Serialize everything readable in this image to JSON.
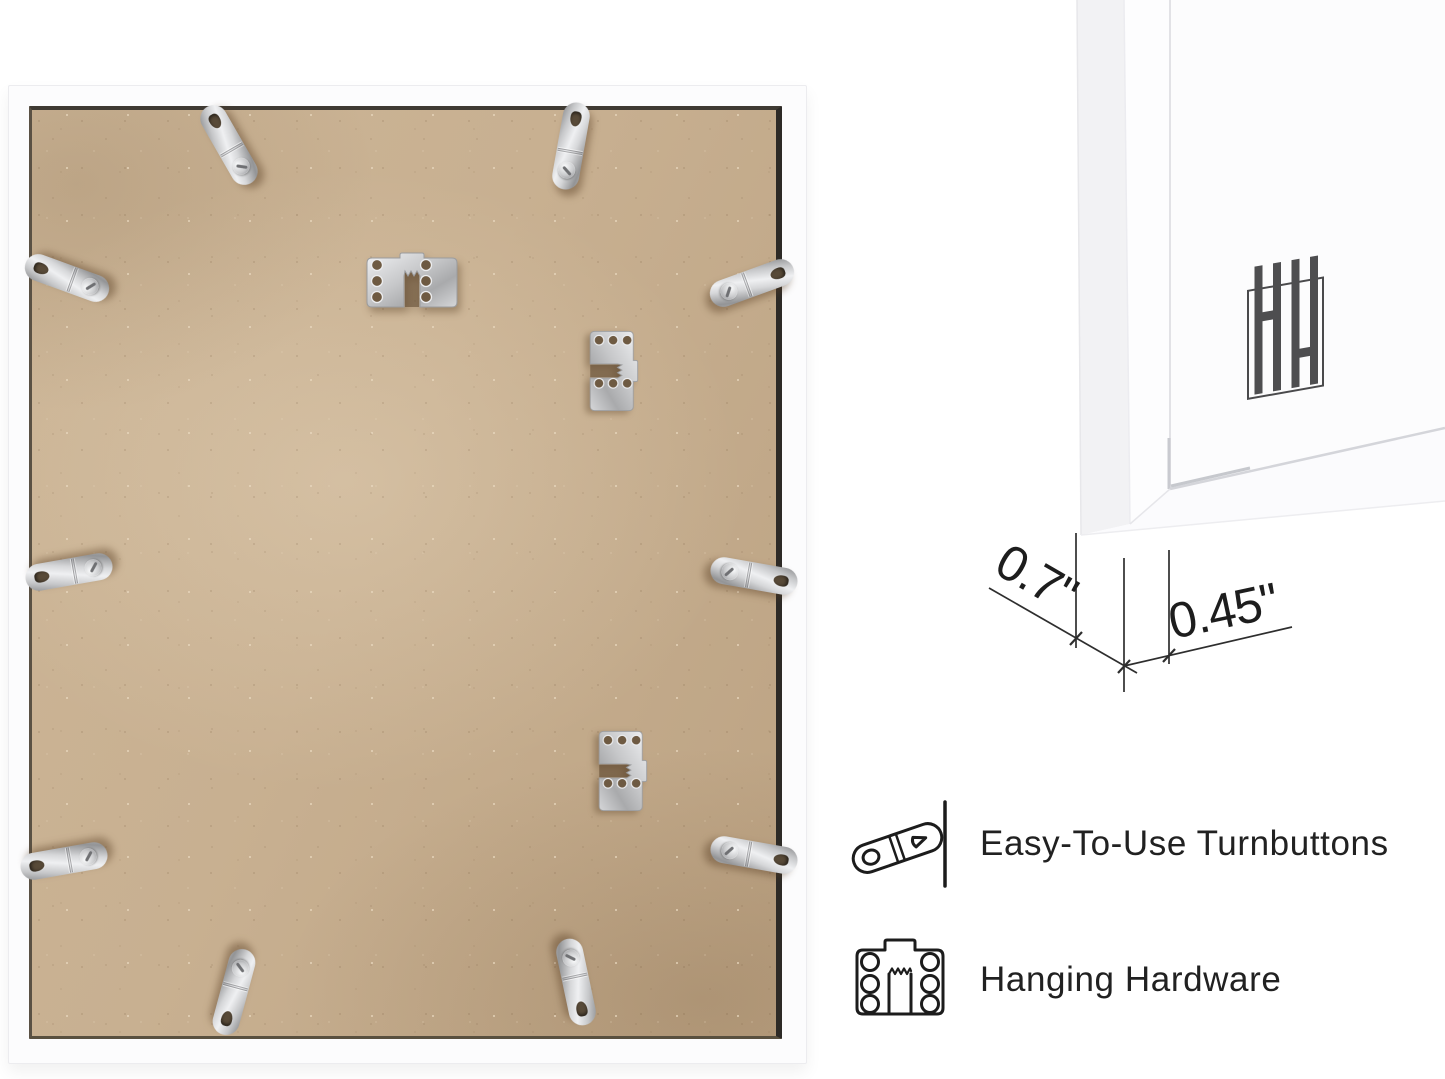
{
  "page": {
    "background": "#ffffff"
  },
  "back_view": {
    "mdf_color": "#c8b091",
    "frame_color": "#fcfcfd",
    "turnbuttons": [
      {
        "x": 220,
        "y": 59,
        "rot": -30
      },
      {
        "x": 562,
        "y": 60,
        "rot": 10
      },
      {
        "x": 58,
        "y": 192,
        "rot": -70
      },
      {
        "x": 743,
        "y": 197,
        "rot": 70
      },
      {
        "x": 60,
        "y": 486,
        "rot": -100
      },
      {
        "x": 745,
        "y": 490,
        "rot": 100
      },
      {
        "x": 55,
        "y": 775,
        "rot": -100
      },
      {
        "x": 745,
        "y": 769,
        "rot": 100
      },
      {
        "x": 225,
        "y": 906,
        "rot": -165
      },
      {
        "x": 567,
        "y": 896,
        "rot": 168
      }
    ],
    "hangers": [
      {
        "x": 403,
        "y": 194,
        "rot": 0,
        "scale": 1
      },
      {
        "x": 605,
        "y": 285,
        "rot": 90,
        "scale": 0.88
      },
      {
        "x": 614,
        "y": 685,
        "rot": 90,
        "scale": 0.88
      }
    ]
  },
  "closeup": {
    "logo_letters": "HH",
    "logo_color": "#4e4e50",
    "dimensions": {
      "depth_label": "0.7\"",
      "face_label": "0.45\""
    }
  },
  "features": [
    {
      "icon": "turnbutton-icon",
      "label": "Easy-To-Use Turnbuttons"
    },
    {
      "icon": "hanging-hardware-icon",
      "label": "Hanging Hardware"
    }
  ],
  "colors": {
    "metal": "#cfd0d2",
    "ink": "#1d1d1d",
    "shadow": "#584a38"
  }
}
